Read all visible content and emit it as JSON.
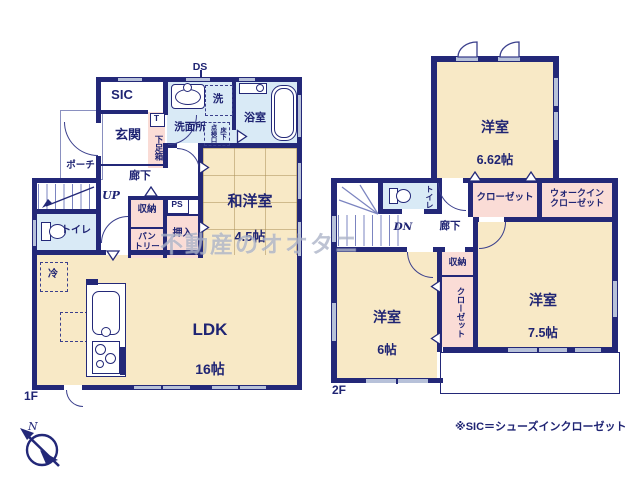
{
  "colors": {
    "wall": "#232878",
    "room_beige": "#f8e9c6",
    "closet_pink": "#fadcd6",
    "wet_blue": "#d9eaf6",
    "window_gray": "#b7c1d9",
    "text_navy": "#1f2473"
  },
  "watermark": "不動産のオオタニ",
  "footnote": "※SIC＝シューズインクローゼット",
  "compass": {
    "north_label": "N"
  },
  "floor1": {
    "floor_label": "1F",
    "duct_label": "DS",
    "sic": "SIC",
    "genkan": "玄関",
    "porch": "ポーチ",
    "senmenjo": "洗面所",
    "washer": "洗",
    "bath": "浴室",
    "inspection_hatch": "床下\n点検口",
    "shoe_t": "T",
    "shoe_box": "下足箱",
    "hallway": "廊下",
    "stairs_up": "UP",
    "storage": "収納",
    "ps": "PS",
    "pantry": "パン\nトリー",
    "oshiire": "押入",
    "toilet": "トイレ",
    "fridge": "冷",
    "wayoshitsu_name": "和洋室",
    "wayoshitsu_size": "4.5帖",
    "ldk_name": "LDK",
    "ldk_size": "16帖"
  },
  "floor2": {
    "floor_label": "2F",
    "room1_name": "洋室",
    "room1_size": "6.62帖",
    "closet1": "クローゼット",
    "wic": "ウォークイン\nクローゼット",
    "toilet": "トイレ",
    "stairs_dn": "DN",
    "hallway": "廊下",
    "storage": "収納",
    "closet2": "クローゼット",
    "room2_name": "洋室",
    "room2_size": "6帖",
    "room3_name": "洋室",
    "room3_size": "7.5帖"
  }
}
